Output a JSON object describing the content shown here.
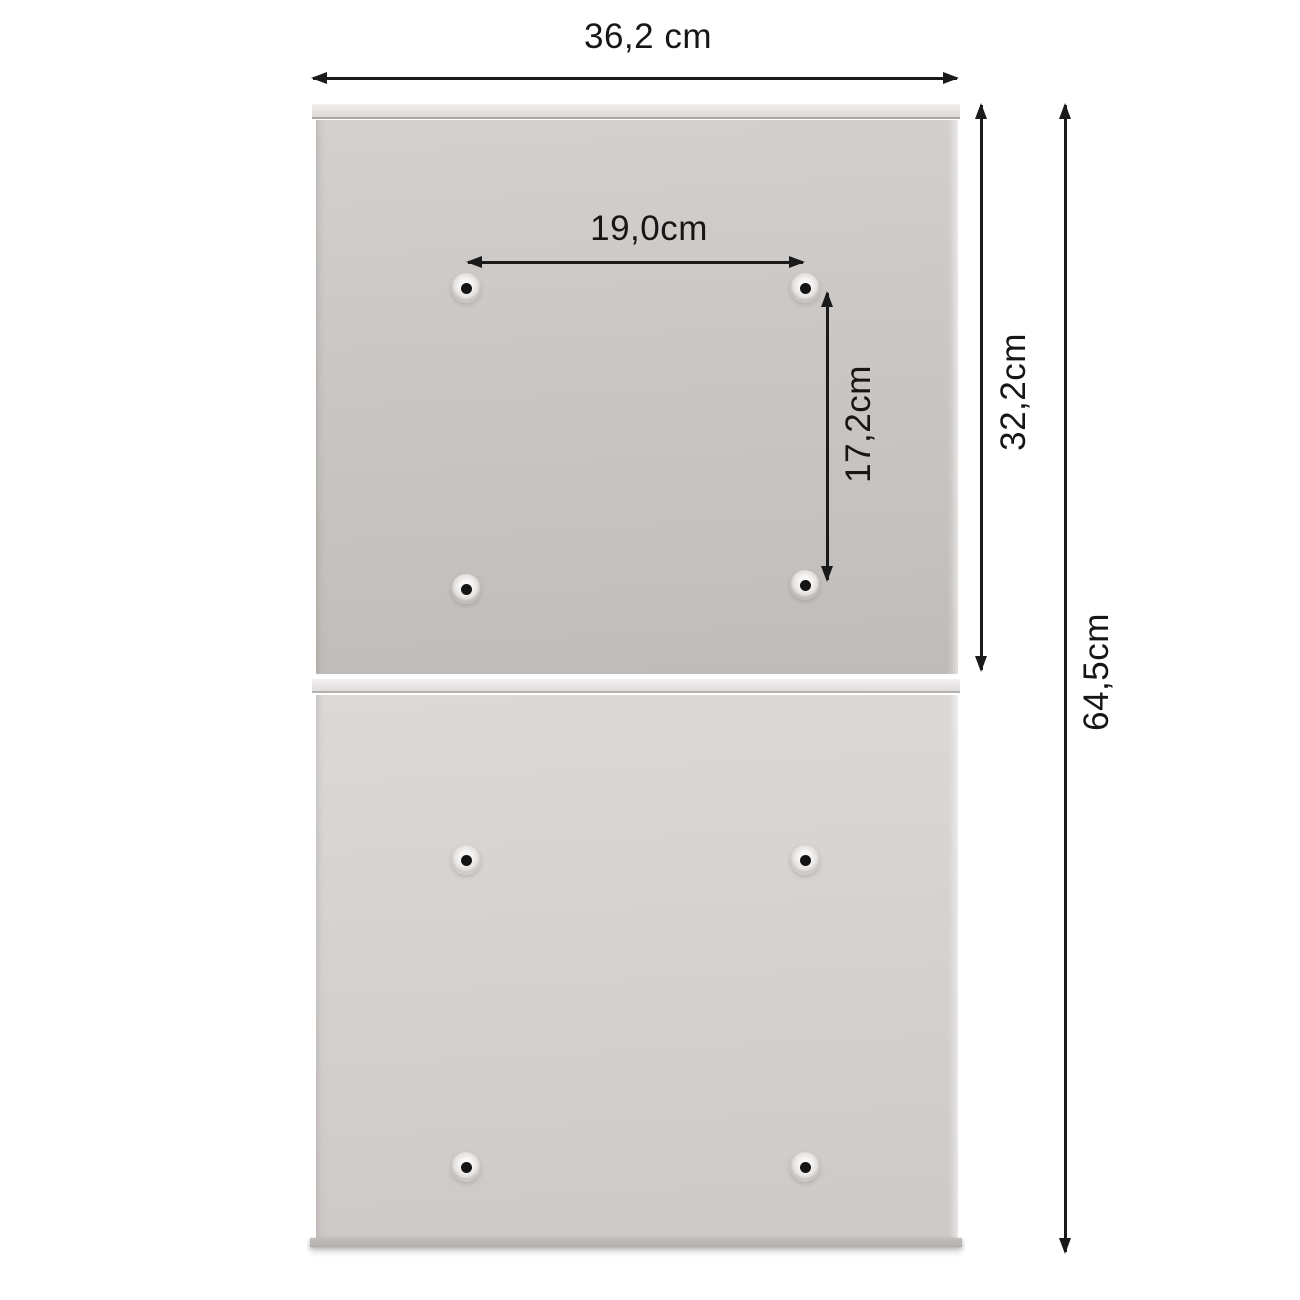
{
  "page": {
    "type": "product-dimension-diagram",
    "background": "#ffffff",
    "arrow_color": "#1a1a1a",
    "panels": {
      "top": {
        "description": "upper mounting panel with 4 screw holes",
        "color": "#c9c5c2"
      },
      "bottom": {
        "description": "lower mounting panel with 4 screw holes",
        "color": "#d6d3d1"
      },
      "mounting_holes_per_panel": 4
    },
    "measurements": {
      "total_width": {
        "label": "36,2 cm",
        "value_cm": 36.2,
        "orientation": "horizontal",
        "refers_to": "overall panel width"
      },
      "hole_spacing_horizontal": {
        "label": "19,0cm",
        "value_cm": 19.0,
        "orientation": "horizontal",
        "refers_to": "horizontal distance between screw holes"
      },
      "hole_spacing_vertical": {
        "label": "17,2cm",
        "value_cm": 17.2,
        "orientation": "vertical",
        "refers_to": "vertical distance between screw holes"
      },
      "upper_panel_height": {
        "label": "32,2cm",
        "value_cm": 32.2,
        "orientation": "vertical",
        "refers_to": "height of one panel"
      },
      "total_height": {
        "label": "64,5cm",
        "value_cm": 64.5,
        "orientation": "vertical",
        "refers_to": "overall height of both panels"
      }
    }
  }
}
